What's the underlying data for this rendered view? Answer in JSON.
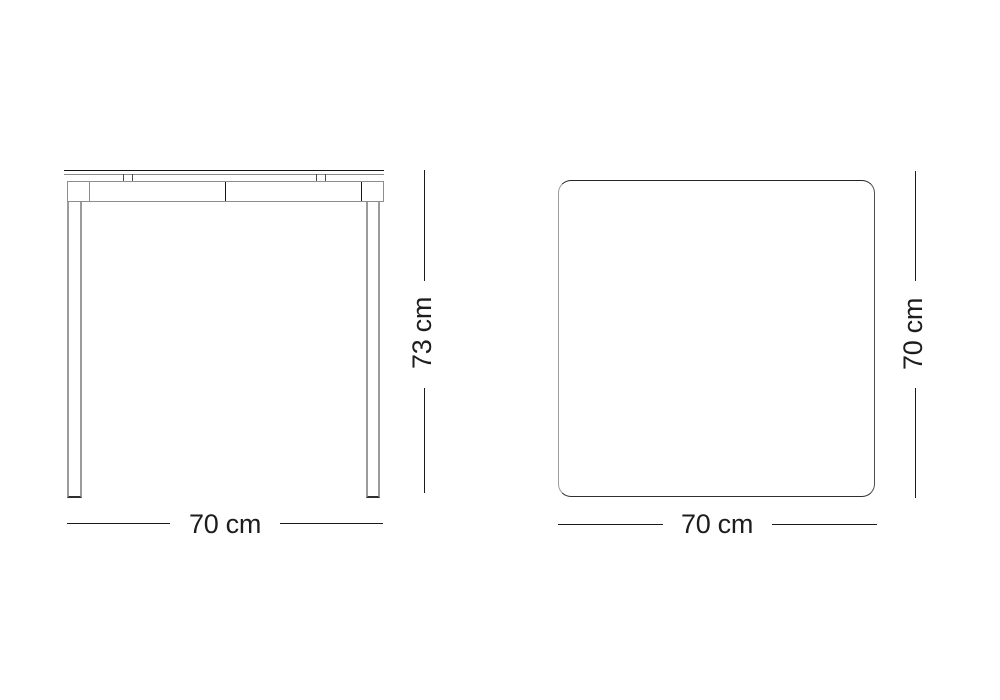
{
  "diagram": {
    "front_view": {
      "height_dimension": "73 cm",
      "width_dimension": "70 cm"
    },
    "top_view": {
      "depth_dimension": "70 cm",
      "width_dimension": "70 cm"
    }
  },
  "colors": {
    "background": "#ffffff",
    "dimension_line": "#1b1b1b",
    "text_color": "#1d1d1d",
    "outline_dark": "#2a2a2a",
    "outline_gray": "#949494"
  }
}
